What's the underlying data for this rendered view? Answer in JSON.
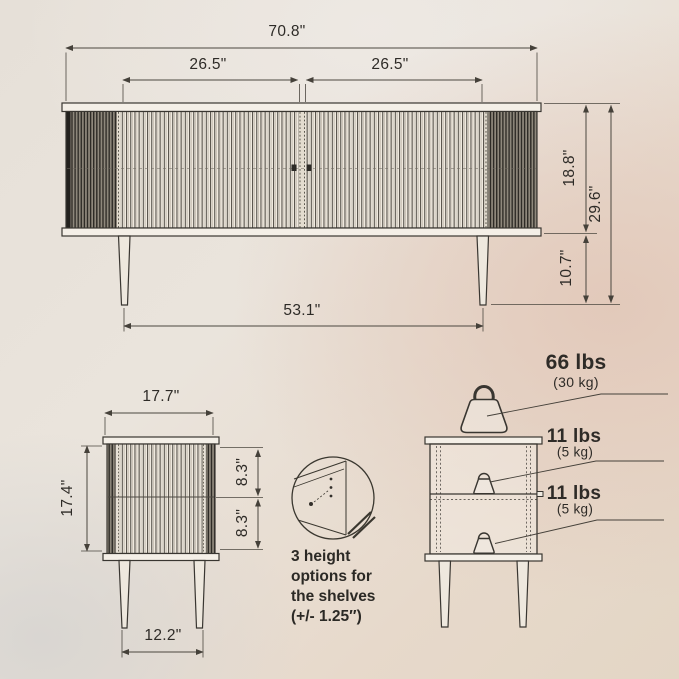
{
  "title": "Furniture dimensions diagram",
  "colors": {
    "line": "#3a372f",
    "dim_line": "#4b473f",
    "text": "#2e2b27",
    "band_fill": "#f4efe7"
  },
  "front_view": {
    "dim_total_width": "70.8\"",
    "dim_door_left": "26.5\"",
    "dim_door_right": "26.5\"",
    "dim_body_height": "18.8\"",
    "dim_total_height": "29.6\"",
    "dim_leg_height": "10.7\"",
    "dim_leg_span": "53.1\""
  },
  "side_view": {
    "dim_depth": "17.7\"",
    "dim_body_height": "17.4\"",
    "dim_shelf_upper": "8.3\"",
    "dim_shelf_lower": "8.3\"",
    "dim_leg_span": "12.2\""
  },
  "shelf_detail": {
    "note": "3 height\noptions for\nthe shelves\n(+/- 1.25″)"
  },
  "load_capacity": {
    "top_lbs": "66 lbs",
    "top_kg": "(30 kg)",
    "shelf_lbs": "11 lbs",
    "shelf_kg": "(5 kg)",
    "bottom_lbs": "11 lbs",
    "bottom_kg": "(5 kg)"
  }
}
